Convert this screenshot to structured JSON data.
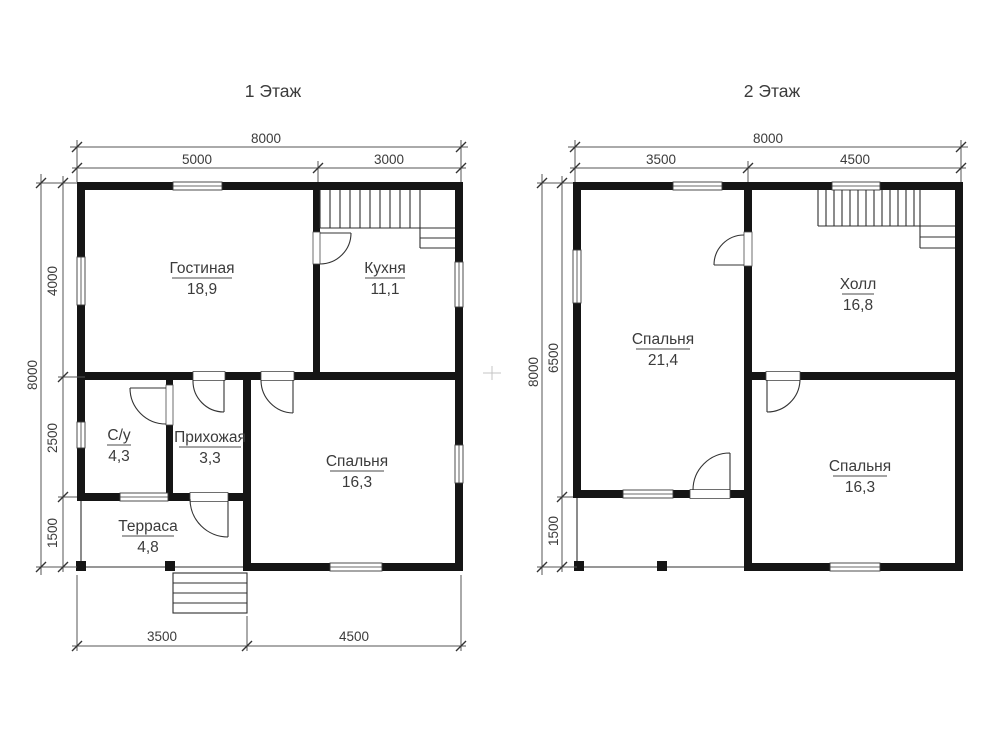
{
  "document": {
    "type": "house-floor-plan"
  },
  "floors": [
    {
      "title": "1 Этаж",
      "dims": {
        "width_total": "8000",
        "top": [
          "5000",
          "3000"
        ],
        "height_total": "8000",
        "left": [
          "4000",
          "2500",
          "1500"
        ],
        "bottom": [
          "3500",
          "4500"
        ]
      },
      "rooms": [
        {
          "name": "Гостиная",
          "area": "18,9"
        },
        {
          "name": "Кухня",
          "area": "11,1"
        },
        {
          "name": "С/у",
          "area": "4,3"
        },
        {
          "name": "Прихожая",
          "area": "3,3"
        },
        {
          "name": "Спальня",
          "area": "16,3"
        },
        {
          "name": "Терраса",
          "area": "4,8"
        }
      ]
    },
    {
      "title": "2 Этаж",
      "dims": {
        "width_total": "8000",
        "top": [
          "3500",
          "4500"
        ],
        "height_total": "8000",
        "left": [
          "6500",
          "1500"
        ]
      },
      "rooms": [
        {
          "name": "Спальня",
          "area": "21,4"
        },
        {
          "name": "Холл",
          "area": "16,8"
        },
        {
          "name": "Спальня",
          "area": "16,3"
        }
      ]
    }
  ],
  "colors": {
    "wall": "#151515",
    "line": "#555555",
    "text": "#3b3b3b",
    "bg": "#ffffff"
  }
}
